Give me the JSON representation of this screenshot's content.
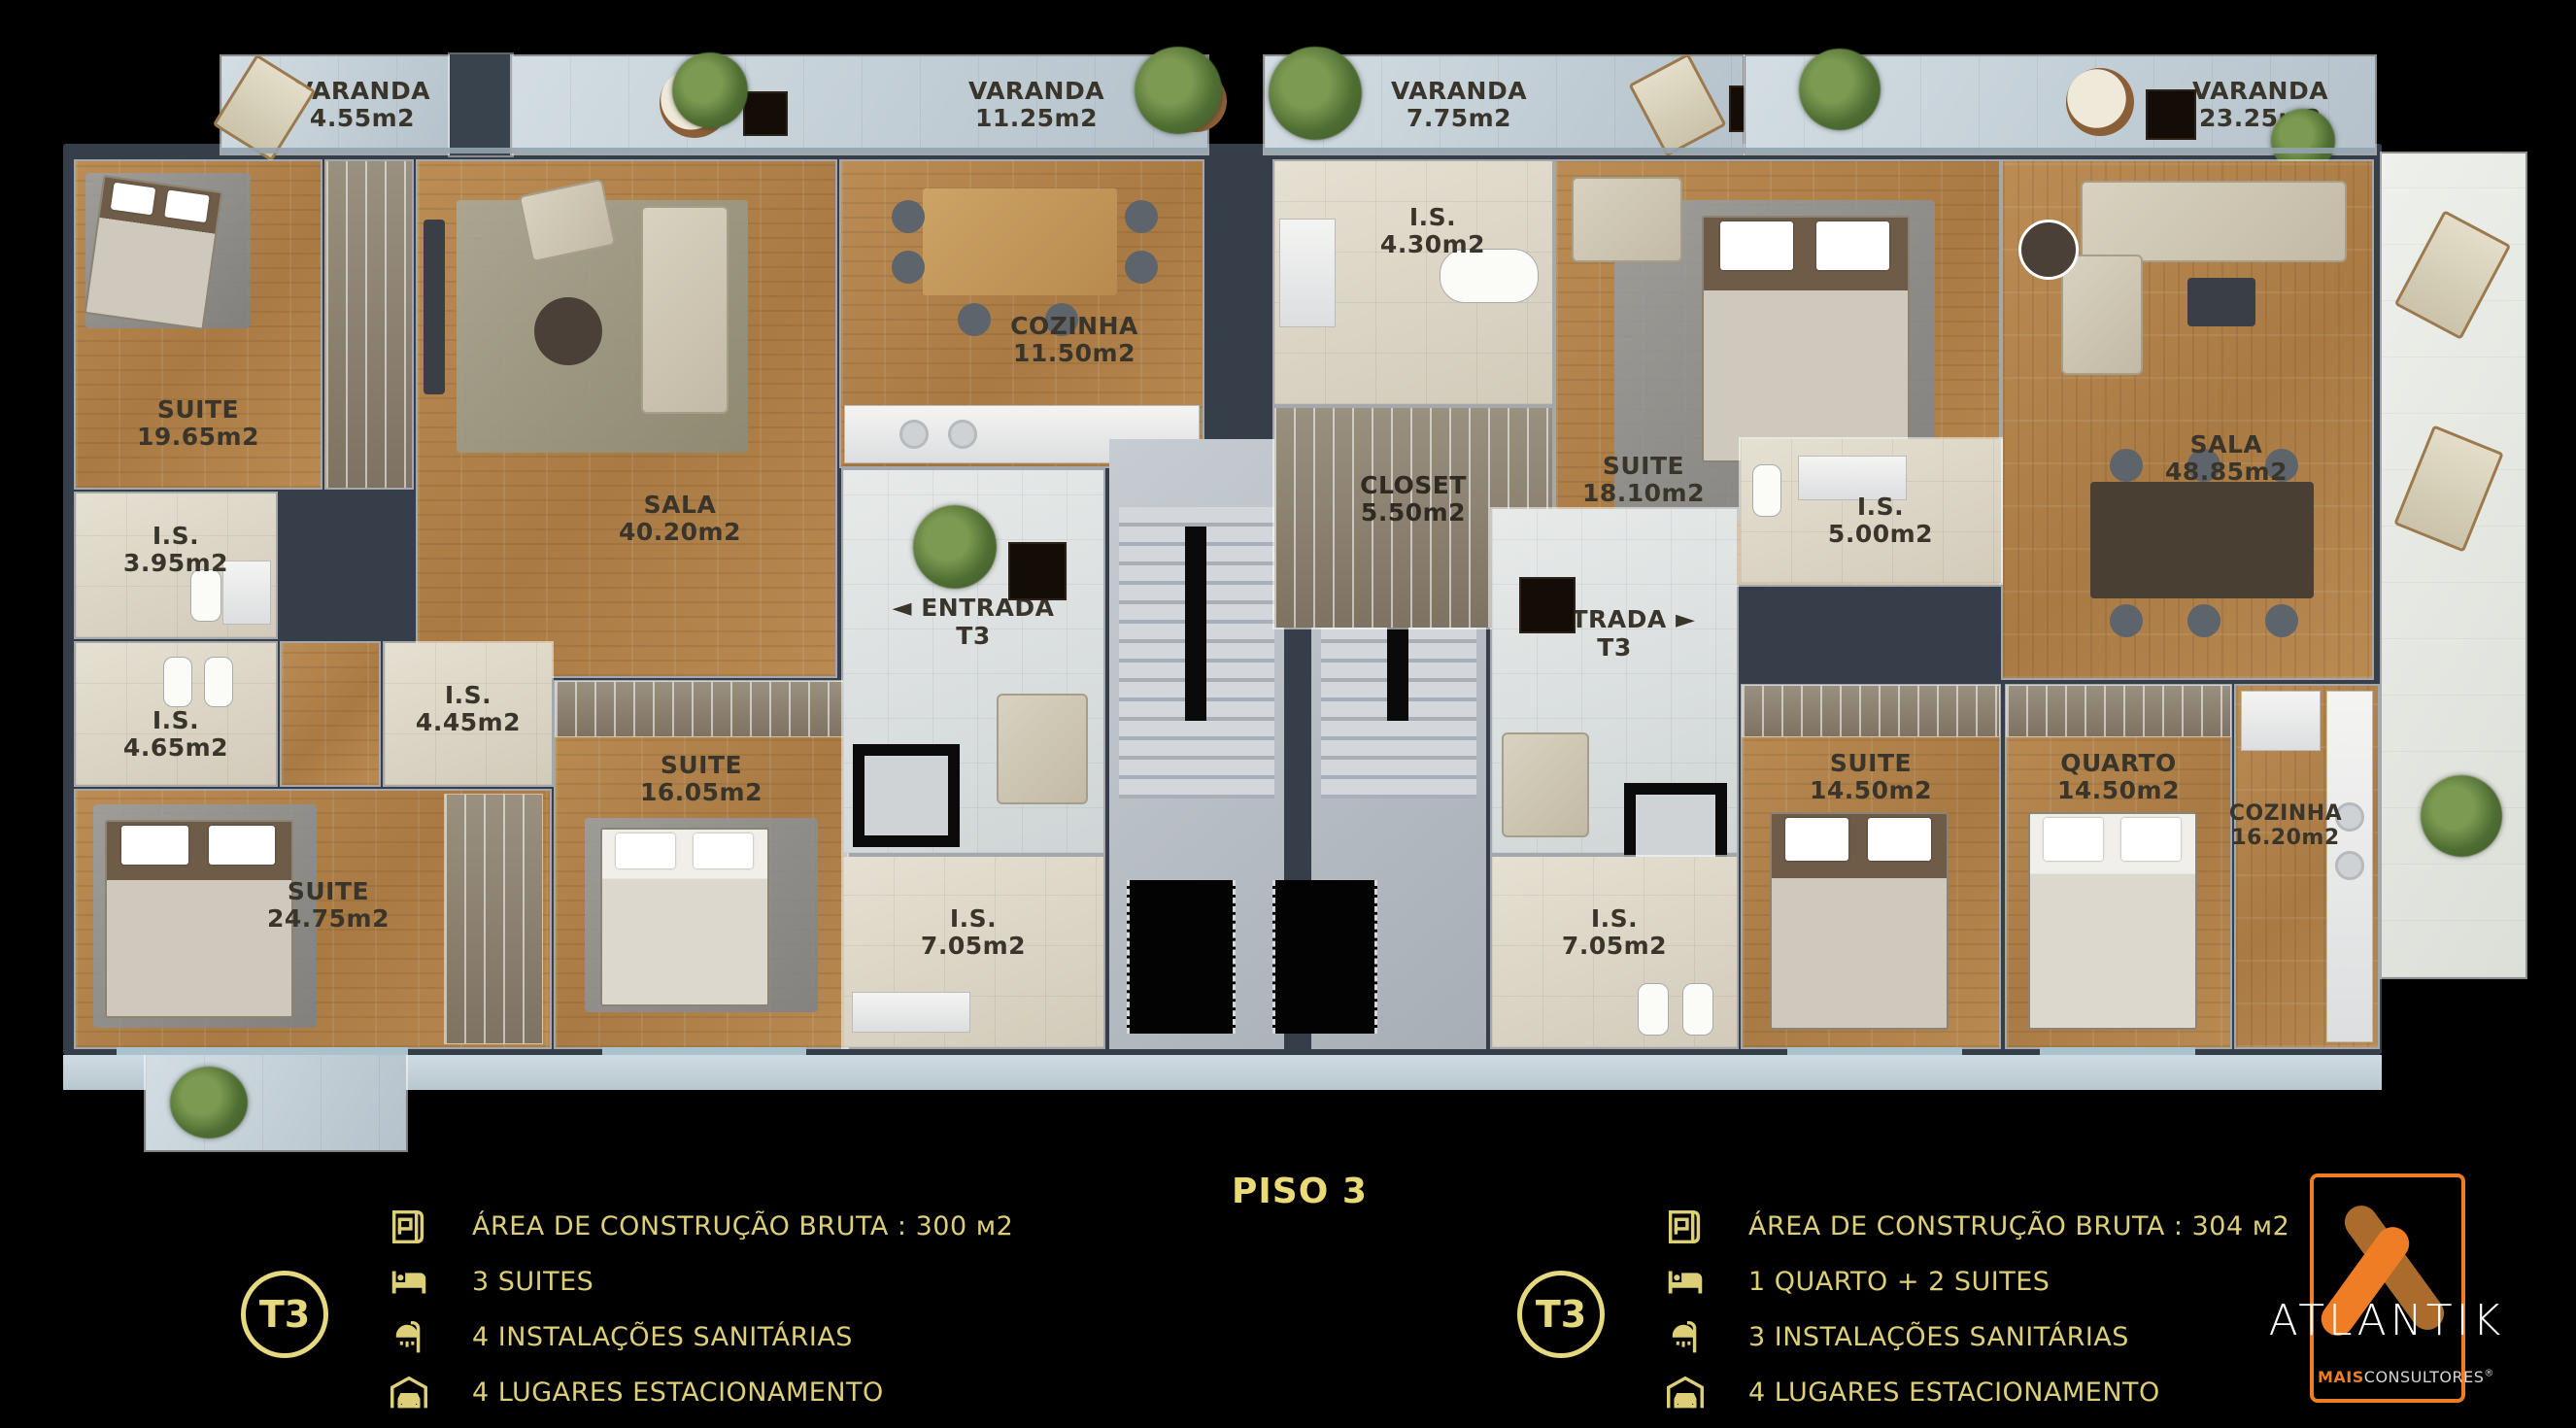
{
  "page": {
    "floor_label": "PISO 3"
  },
  "varandas": {
    "v1": {
      "name": "VARANDA",
      "area": "4.55m2"
    },
    "v2": {
      "name": "VARANDA",
      "area": "11.25m2"
    },
    "v3": {
      "name": "VARANDA",
      "area": "7.75m2"
    },
    "v4": {
      "name": "VARANDA",
      "area": "23.25m2"
    }
  },
  "rooms": {
    "l_suite19": {
      "name": "SUITE",
      "area": "19.65m2"
    },
    "l_sala": {
      "name": "SALA",
      "area": "40.20m2"
    },
    "l_cozinha": {
      "name": "COZINHA",
      "area": "11.50m2"
    },
    "l_is395": {
      "name": "I.S.",
      "area": "3.95m2"
    },
    "l_is465": {
      "name": "I.S.",
      "area": "4.65m2"
    },
    "l_is445": {
      "name": "I.S.",
      "area": "4.45m2"
    },
    "l_suite24": {
      "name": "SUITE",
      "area": "24.75m2"
    },
    "l_suite16": {
      "name": "SUITE",
      "area": "16.05m2"
    },
    "l_entrada": {
      "name": "ENTRADA",
      "area": "T3",
      "arrow": "◄"
    },
    "l_is705": {
      "name": "I.S.",
      "area": "7.05m2"
    },
    "r_is430": {
      "name": "I.S.",
      "area": "4.30m2"
    },
    "r_closet": {
      "name": "CLOSET",
      "area": "5.50m2"
    },
    "r_suite18": {
      "name": "SUITE",
      "area": "18.10m2"
    },
    "r_is500": {
      "name": "I.S.",
      "area": "5.00m2"
    },
    "r_sala": {
      "name": "SALA",
      "area": "48.85m2"
    },
    "r_entrada": {
      "name": "ENTRADA",
      "area": "T3",
      "arrow": "►"
    },
    "r_suite14": {
      "name": "SUITE",
      "area": "14.50m2"
    },
    "r_quarto": {
      "name": "QUARTO",
      "area": "14.50m2"
    },
    "r_cozinha": {
      "name": "COZINHA",
      "area": "16.20m2"
    },
    "r_is705": {
      "name": "I.S.",
      "area": "7.05m2"
    }
  },
  "legend_left": {
    "badge": "T3",
    "items": [
      {
        "icon": "blueprint-icon",
        "label": "ÁREA DE CONSTRUÇÃO BRUTA :  300 м2"
      },
      {
        "icon": "bed-icon",
        "label": "3 SUITES"
      },
      {
        "icon": "shower-icon",
        "label": "4 INSTALAÇÕES SANITÁRIAS"
      },
      {
        "icon": "garage-icon",
        "label": "4 LUGARES ESTACIONAMENTO"
      }
    ]
  },
  "legend_right": {
    "badge": "T3",
    "items": [
      {
        "icon": "blueprint-icon",
        "label": "ÁREA DE CONSTRUÇÃO BRUTA :  304 м2"
      },
      {
        "icon": "bed-icon",
        "label": "1 QUARTO + 2 SUITES"
      },
      {
        "icon": "shower-icon",
        "label": "3 INSTALAÇÕES SANITÁRIAS"
      },
      {
        "icon": "garage-icon",
        "label": "4 LUGARES ESTACIONAMENTO"
      }
    ]
  },
  "logo": {
    "brand": "ATLANTIK",
    "sub_bold": "MAIS",
    "sub_rest": "CONSULTORES",
    "registered": "®"
  },
  "colors": {
    "gold": "#e6d87e",
    "orange": "#ef7d23",
    "orange_dark": "#aa6b2c",
    "wall": "#353e49"
  }
}
